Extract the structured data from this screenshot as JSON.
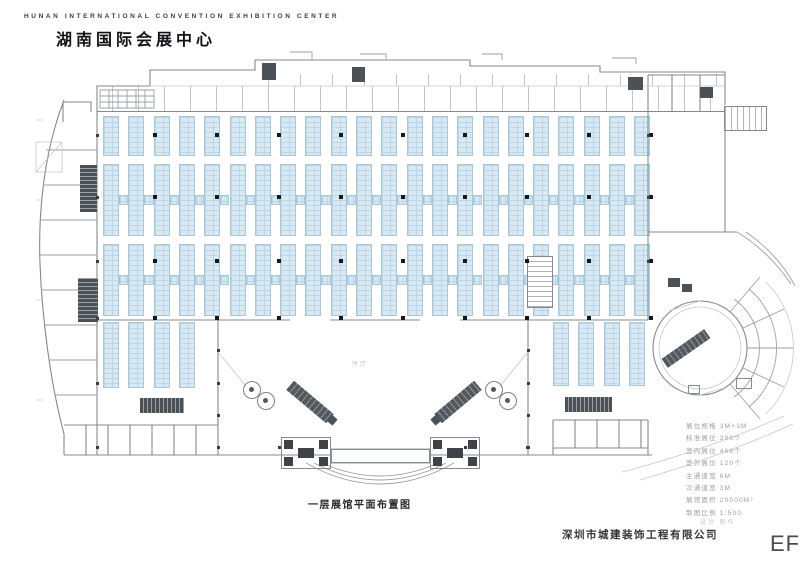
{
  "header": {
    "title_en": "HUNAN INTERNATIONAL CONVENTION EXHIBITION CENTER",
    "title_zh": "湖南国际会展中心"
  },
  "plan": {
    "lobby_label": "序厅",
    "caption": "一层展馆平面布置图"
  },
  "legend": {
    "lines": [
      "展位规格 3M×3M",
      "标准展位 396个",
      "室内展位 468个",
      "室外展位 120个",
      "主通道宽 6M",
      "次通道宽 3M",
      "展馆面积 20000M²",
      "制图比例 1:500"
    ]
  },
  "footer": {
    "company_note": "设计 制作",
    "company": "深圳市城建装饰工程有限公司",
    "watermark": "EF"
  },
  "colors": {
    "booth_fill": "#d9e9f4",
    "booth_grid": "#bcd6e6",
    "booth_border": "#a9c8da",
    "wall": "#85898e",
    "dark_hatch": "#4c5156",
    "ink": "#1a1a1a"
  }
}
